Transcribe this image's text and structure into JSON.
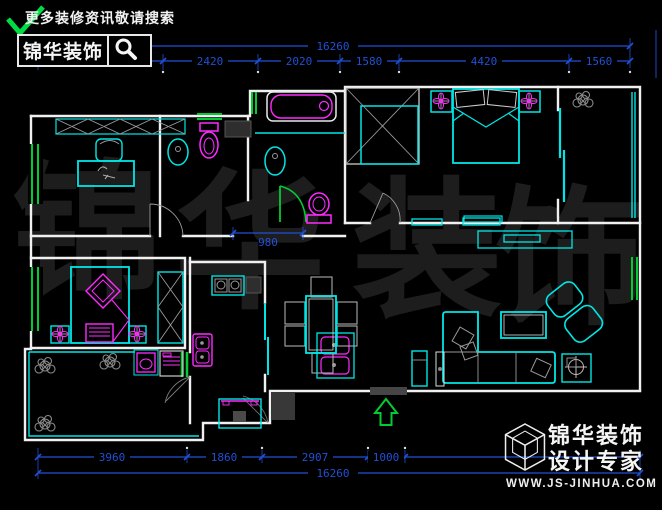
{
  "logo_top": {
    "tagline": "更多装修资讯敬请搜索",
    "brand": "锦华装饰",
    "search_icon": "magnifier"
  },
  "watermark": {
    "chars": [
      "锦",
      "华",
      "装",
      "饰"
    ]
  },
  "dims": {
    "top_total": "16260",
    "top_segments": [
      "3420",
      "2420",
      "2020",
      "1580",
      "4420",
      "1560"
    ],
    "bottom_total": "16260",
    "bottom_segments": [
      "3960",
      "1860",
      "2907",
      "1000"
    ],
    "interior": "980"
  },
  "logo_bottom": {
    "brand": "锦华装饰",
    "tagline": "设计专家",
    "url": "WWW.JS-JINHUA.COM"
  },
  "colors": {
    "background": "#000000",
    "wall": "#f0f0f0",
    "furniture_cyan": "#00e6e6",
    "fixture_magenta": "#ff2bff",
    "window_green": "#00cc33",
    "dimension_blue": "#2050d5",
    "watermark_gray": "#1d1d1d",
    "hatch_gray": "#9a9a9a"
  }
}
